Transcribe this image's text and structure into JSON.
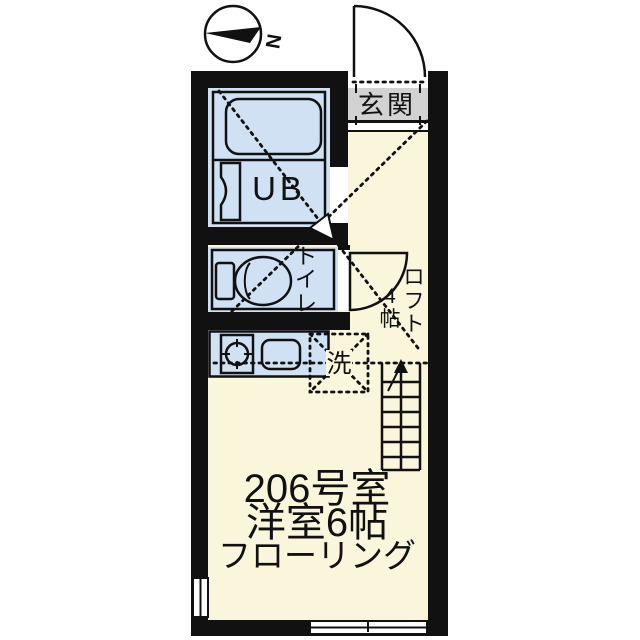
{
  "plan": {
    "compass": {
      "label": "N"
    },
    "entrance": {
      "label": "玄関"
    },
    "unit_bath": {
      "label": "UB"
    },
    "toilet": {
      "label": "トイレ",
      "chars": [
        "ト",
        "イ",
        "レ"
      ]
    },
    "loft": {
      "label": "ロフト",
      "size": "4帖",
      "label_chars": [
        "ロ",
        "フ",
        "ト"
      ],
      "size_chars": [
        "4",
        "帖"
      ]
    },
    "washer": {
      "label": "洗"
    },
    "caption": {
      "room_number": "206号室",
      "room_type": "洋室6帖",
      "flooring": "フローリング"
    },
    "colors": {
      "wall": "#111111",
      "wet_area": "#cfe1f2",
      "living": "#faf6dc",
      "entrance": "#d2d2d2",
      "outline": "#111111"
    }
  }
}
